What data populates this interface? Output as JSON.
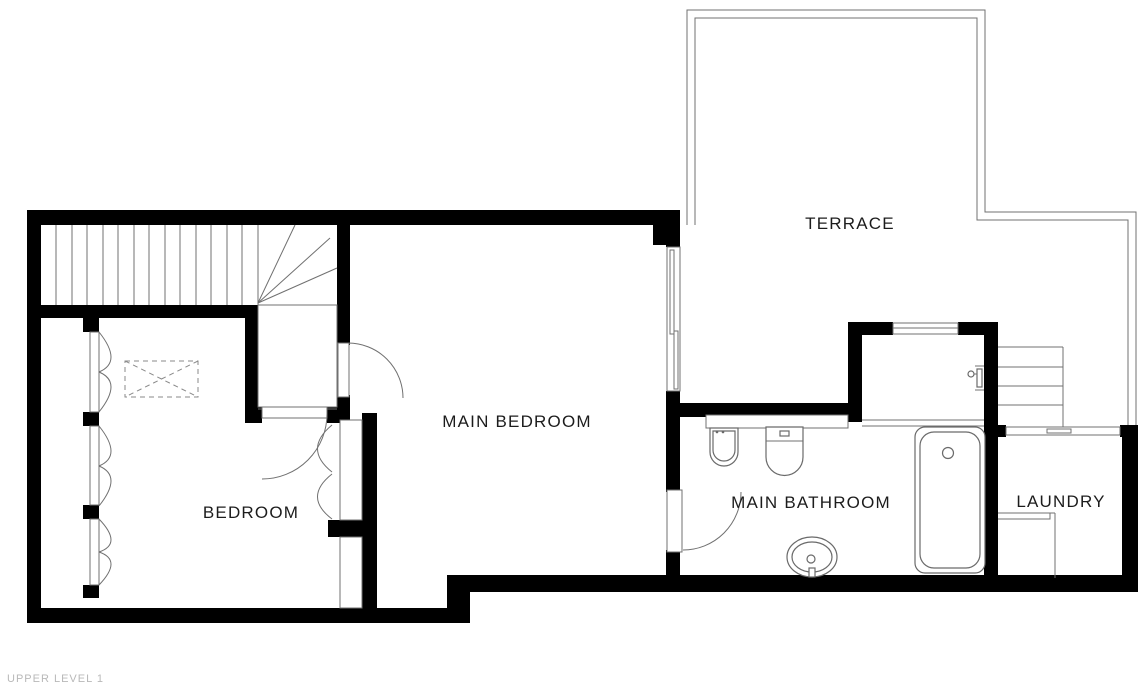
{
  "title": "Floor plan - Upper Level 1",
  "level": {
    "label": "UPPER LEVEL 1"
  },
  "rooms": [
    {
      "id": "terrace",
      "label": "TERRACE"
    },
    {
      "id": "main-bedroom",
      "label": "MAIN BEDROOM"
    },
    {
      "id": "bedroom",
      "label": "BEDROOM"
    },
    {
      "id": "main-bathroom",
      "label": "MAIN BATHROOM"
    },
    {
      "id": "laundry",
      "label": "LAUNDRY"
    }
  ],
  "fixtures": [
    "staircase-interior",
    "winder-steps",
    "stair-landing",
    "staircase-exterior",
    "terrace-railing",
    "sliding-door-terrace",
    "window-shower",
    "sliding-window-laundry",
    "wardrobe-bifold-doors",
    "closet",
    "skylight-dashed",
    "door-main-bedroom",
    "door-bedroom",
    "door-bathroom",
    "closet-double-doors",
    "bathroom-counter",
    "bidet",
    "toilet",
    "sink",
    "bathtub",
    "shower-mixer",
    "laundry-counter"
  ],
  "colors": {
    "wall": "#000000",
    "thin_line": "#707070",
    "fixture_line": "#6a6a6a",
    "label_text": "#1c1c1c",
    "muted_text": "#b9b9b9",
    "background": "#ffffff"
  }
}
